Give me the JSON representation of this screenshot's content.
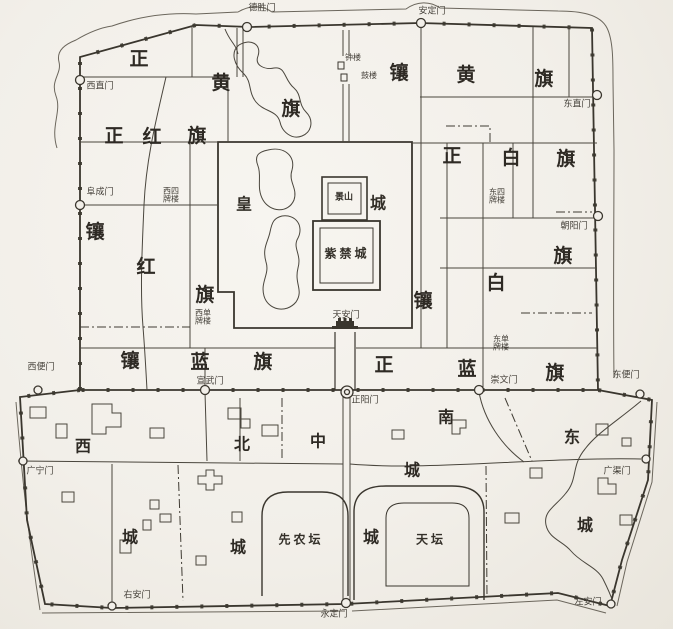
{
  "canvas": {
    "width": 673,
    "height": 629,
    "paper_color": "#f2efe9",
    "ink_color": "#3a362e"
  },
  "labels": [
    {
      "id": "gate-deshengmen",
      "text": "德胜门",
      "x": 262,
      "y": 9,
      "cls": "gate"
    },
    {
      "id": "gate-andingmen",
      "text": "安定门",
      "x": 432,
      "y": 12,
      "cls": "gate"
    },
    {
      "id": "gate-xizhimen",
      "text": "西直门",
      "x": 100,
      "y": 87,
      "cls": "gate"
    },
    {
      "id": "gate-fuchengmen",
      "text": "阜成门",
      "x": 100,
      "y": 193,
      "cls": "gate"
    },
    {
      "id": "gate-dongzhimen",
      "text": "东直门",
      "x": 577,
      "y": 105,
      "cls": "gate"
    },
    {
      "id": "gate-chaoyangmen",
      "text": "朝阳门",
      "x": 574,
      "y": 227,
      "cls": "gate"
    },
    {
      "id": "gate-xuanwumen",
      "text": "宣武门",
      "x": 210,
      "y": 382,
      "cls": "gate"
    },
    {
      "id": "gate-zhengyangmen",
      "text": "正阳门",
      "x": 365,
      "y": 401,
      "cls": "gate"
    },
    {
      "id": "gate-chongwenmen",
      "text": "崇文门",
      "x": 504,
      "y": 381,
      "cls": "gate"
    },
    {
      "id": "gate-xibianmen",
      "text": "西便门",
      "x": 41,
      "y": 368,
      "cls": "gate"
    },
    {
      "id": "gate-dongbianmen",
      "text": "东便门",
      "x": 626,
      "y": 376,
      "cls": "gate"
    },
    {
      "id": "gate-guangningmen",
      "text": "广宁门",
      "x": 40,
      "y": 472,
      "cls": "gate"
    },
    {
      "id": "gate-guangqumen",
      "text": "广渠门",
      "x": 617,
      "y": 472,
      "cls": "gate"
    },
    {
      "id": "gate-youanmen",
      "text": "右安门",
      "x": 137,
      "y": 596,
      "cls": "gate"
    },
    {
      "id": "gate-yongdingmen",
      "text": "永定门",
      "x": 334,
      "y": 615,
      "cls": "gate"
    },
    {
      "id": "gate-zuoanmen",
      "text": "左安门",
      "x": 588,
      "y": 603,
      "cls": "gate"
    },
    {
      "id": "tower-zhonglou",
      "text": "钟楼",
      "x": 353,
      "y": 58,
      "cls": "tower"
    },
    {
      "id": "tower-gulou",
      "text": "鼓楼",
      "x": 369,
      "y": 76,
      "cls": "tower"
    },
    {
      "id": "jingshan",
      "text": "景山",
      "x": 344,
      "y": 198,
      "cls": "place-sm"
    },
    {
      "id": "imperial-city-huang",
      "text": "皇",
      "x": 244,
      "y": 205,
      "cls": "place-lg"
    },
    {
      "id": "imperial-city-cheng",
      "text": "城",
      "x": 378,
      "y": 204,
      "cls": "place-lg"
    },
    {
      "id": "forbidden-city-label",
      "text": "紫禁城",
      "x": 347,
      "y": 254,
      "cls": "place-md"
    },
    {
      "id": "tiananmen-label",
      "text": "天安门",
      "x": 346,
      "y": 316,
      "cls": "gate"
    },
    {
      "id": "pailou-xisi",
      "text": "西四\n牌楼",
      "x": 171,
      "y": 196,
      "cls": "pailou"
    },
    {
      "id": "pailou-dongsi",
      "text": "东四\n牌楼",
      "x": 497,
      "y": 197,
      "cls": "pailou"
    },
    {
      "id": "pailou-xidan",
      "text": "西单\n牌楼",
      "x": 203,
      "y": 318,
      "cls": "pailou"
    },
    {
      "id": "pailou-dongdan",
      "text": "东单\n牌楼",
      "x": 501,
      "y": 344,
      "cls": "pailou"
    },
    {
      "id": "xiannongtan-label",
      "text": "先农坛",
      "x": 301,
      "y": 540,
      "cls": "place-md"
    },
    {
      "id": "tiantan-label",
      "text": "天坛",
      "x": 431,
      "y": 540,
      "cls": "place-md"
    },
    {
      "id": "banner-zhenghuang-1",
      "text": "正",
      "x": 139,
      "y": 60,
      "cls": "banner"
    },
    {
      "id": "banner-zhenghuang-2",
      "text": "黄",
      "x": 221,
      "y": 84,
      "cls": "banner"
    },
    {
      "id": "banner-zhenghuang-3",
      "text": "旗",
      "x": 291,
      "y": 110,
      "cls": "banner"
    },
    {
      "id": "banner-xianghuang-1",
      "text": "镶",
      "x": 399,
      "y": 74,
      "cls": "banner"
    },
    {
      "id": "banner-xianghuang-2",
      "text": "黄",
      "x": 466,
      "y": 76,
      "cls": "banner"
    },
    {
      "id": "banner-xianghuang-3",
      "text": "旗",
      "x": 544,
      "y": 80,
      "cls": "banner"
    },
    {
      "id": "banner-zhenghong-1",
      "text": "正",
      "x": 114,
      "y": 137,
      "cls": "banner"
    },
    {
      "id": "banner-zhenghong-2",
      "text": "红",
      "x": 152,
      "y": 138,
      "cls": "banner"
    },
    {
      "id": "banner-zhenghong-3",
      "text": "旗",
      "x": 197,
      "y": 137,
      "cls": "banner"
    },
    {
      "id": "banner-zhengbai-1",
      "text": "正",
      "x": 452,
      "y": 157,
      "cls": "banner"
    },
    {
      "id": "banner-zhengbai-2",
      "text": "白",
      "x": 511,
      "y": 159,
      "cls": "banner"
    },
    {
      "id": "banner-zhengbai-3",
      "text": "旗",
      "x": 566,
      "y": 160,
      "cls": "banner"
    },
    {
      "id": "banner-xianghong-1",
      "text": "镶",
      "x": 95,
      "y": 233,
      "cls": "banner"
    },
    {
      "id": "banner-xianghong-2",
      "text": "红",
      "x": 146,
      "y": 268,
      "cls": "banner"
    },
    {
      "id": "banner-xianghong-3",
      "text": "旗",
      "x": 205,
      "y": 296,
      "cls": "banner"
    },
    {
      "id": "banner-xiangbai-1",
      "text": "镶",
      "x": 423,
      "y": 302,
      "cls": "banner"
    },
    {
      "id": "banner-xiangbai-2",
      "text": "白",
      "x": 496,
      "y": 284,
      "cls": "banner"
    },
    {
      "id": "banner-xiangbai-3",
      "text": "旗",
      "x": 563,
      "y": 257,
      "cls": "banner"
    },
    {
      "id": "banner-xianglan-1",
      "text": "镶",
      "x": 130,
      "y": 362,
      "cls": "banner"
    },
    {
      "id": "banner-xianglan-2",
      "text": "蓝",
      "x": 200,
      "y": 363,
      "cls": "banner"
    },
    {
      "id": "banner-xianglan-3",
      "text": "旗",
      "x": 263,
      "y": 363,
      "cls": "banner"
    },
    {
      "id": "banner-zhenglan-1",
      "text": "正",
      "x": 384,
      "y": 366,
      "cls": "banner"
    },
    {
      "id": "banner-zhenglan-2",
      "text": "蓝",
      "x": 467,
      "y": 370,
      "cls": "banner"
    },
    {
      "id": "banner-zhenglan-3",
      "text": "旗",
      "x": 555,
      "y": 374,
      "cls": "banner"
    },
    {
      "id": "district-xi",
      "text": "西",
      "x": 83,
      "y": 447,
      "cls": "district"
    },
    {
      "id": "district-xi-cheng",
      "text": "城",
      "x": 130,
      "y": 538,
      "cls": "district"
    },
    {
      "id": "district-bei",
      "text": "北",
      "x": 242,
      "y": 445,
      "cls": "district"
    },
    {
      "id": "district-bei-cheng",
      "text": "城",
      "x": 238,
      "y": 548,
      "cls": "district"
    },
    {
      "id": "district-zhong",
      "text": "中",
      "x": 318,
      "y": 442,
      "cls": "district"
    },
    {
      "id": "district-zhong-cheng",
      "text": "城",
      "x": 371,
      "y": 538,
      "cls": "district"
    },
    {
      "id": "district-nan",
      "text": "南",
      "x": 446,
      "y": 418,
      "cls": "district"
    },
    {
      "id": "district-nan-cheng",
      "text": "城",
      "x": 412,
      "y": 471,
      "cls": "district"
    },
    {
      "id": "district-dong",
      "text": "东",
      "x": 572,
      "y": 438,
      "cls": "district"
    },
    {
      "id": "district-dong-cheng",
      "text": "城",
      "x": 585,
      "y": 526,
      "cls": "district"
    }
  ]
}
